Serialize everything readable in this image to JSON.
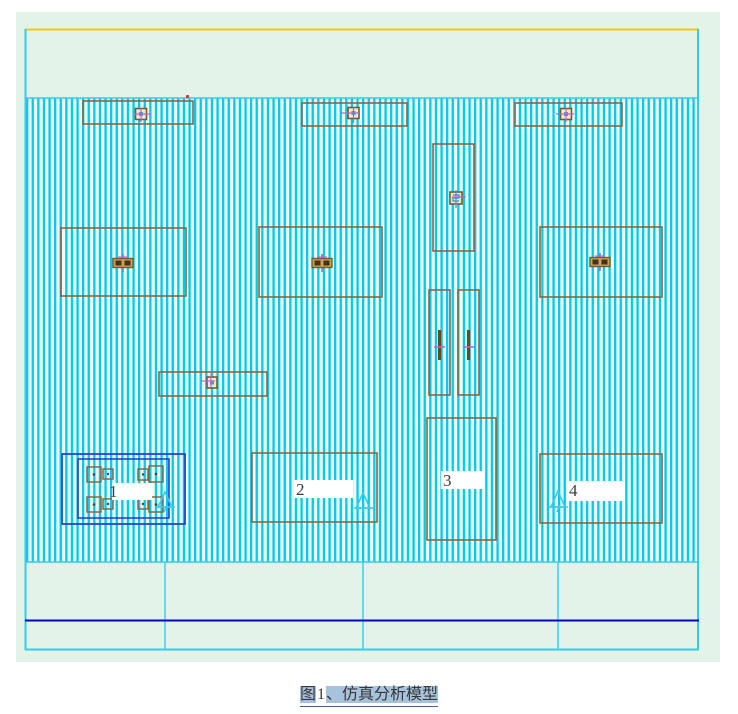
{
  "figure": {
    "caption": {
      "prefix": "图",
      "number": "1",
      "suffix": "、仿真分析模型"
    },
    "areas": [
      {
        "id": "area-1",
        "label": "1"
      },
      {
        "id": "area-2",
        "label": "2"
      },
      {
        "id": "area-3",
        "label": "3"
      },
      {
        "id": "area-4",
        "label": "4"
      }
    ]
  },
  "icons": [
    "pump-unit-icon",
    "motor-unit-icon",
    "valve-icon",
    "fan-unit-icon",
    "datum-triangle-icon",
    "anchor-pad-icon",
    "red-dot-marker"
  ],
  "colors": {
    "panel_bg": "#e2f3e9",
    "stripe_cyan": "#00cbee",
    "stripe_bg": "#edfaf6",
    "frame_cyan": "#35cbee",
    "top_line_yellow": "#eec911",
    "base_line_dark_blue": "#0404c4",
    "equipment_outline_brown": "#8a6642",
    "zone_outline_blue": "#2b3fd8",
    "symbol_magenta": "#c75fc7",
    "symbol_violet": "#7a7ae0",
    "caption_highlight": "#a6c2dc",
    "label_patch": "#ffffff"
  }
}
